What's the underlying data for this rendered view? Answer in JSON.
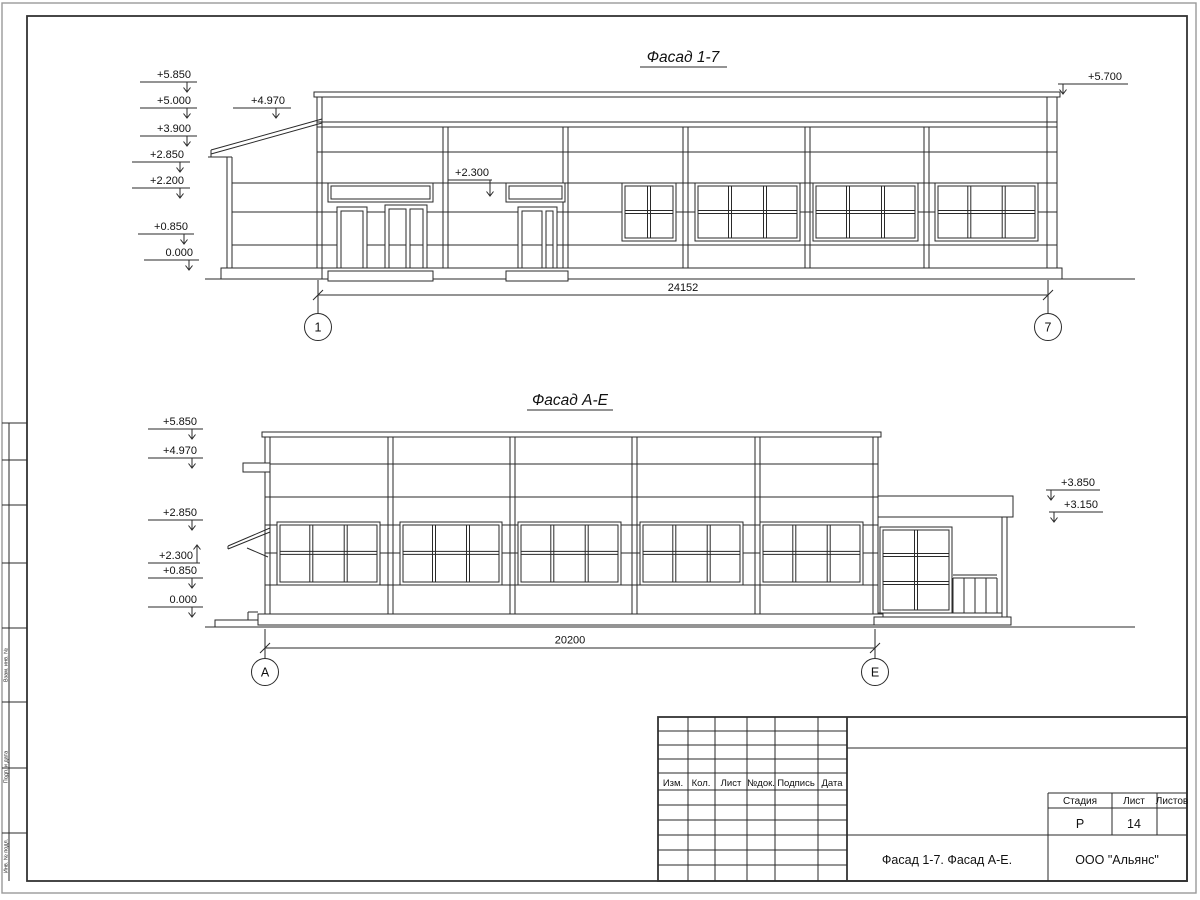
{
  "facade1": {
    "title": "Фасад 1-7",
    "marks": {
      "m1": "+5.850",
      "m2": "+5.000",
      "m3": "+3.900",
      "m4": "+2.850",
      "m5": "+2.200",
      "m6": "+0.850",
      "m7": "0.000",
      "porch": "+4.970",
      "sign": "+2.300",
      "right": "+5.700"
    },
    "dimension": "24152",
    "axis_left": "1",
    "axis_right": "7"
  },
  "facade2": {
    "title": "Фасад А-Е",
    "marks": {
      "m1": "+5.850",
      "m2": "+4.970",
      "m3": "+2.850",
      "m4": "+2.300",
      "m5": "+0.850",
      "m6": "0.000",
      "right1": "+3.850",
      "right2": "+3.150"
    },
    "dimension": "20200",
    "axis_left": "А",
    "axis_right": "Е"
  },
  "title_block": {
    "col_izm": "Изм.",
    "col_kol": "Кол.",
    "col_list": "Лист",
    "col_ndok": "№док.",
    "col_podpis": "Подпись",
    "col_data": "Дата",
    "col_stadia": "Стадия",
    "col_list2": "Лист",
    "col_listov": "Листов",
    "stadia_value": "Р",
    "list_value": "14",
    "listov_value": "",
    "doc_title": "Фасад 1-7. Фасад А-Е.",
    "company": "ООО \"Альянс\""
  },
  "side_stamp": {
    "label1": "Взам. инв. №",
    "label2": "Подп. и дата",
    "label3": "Инв. № подл."
  }
}
